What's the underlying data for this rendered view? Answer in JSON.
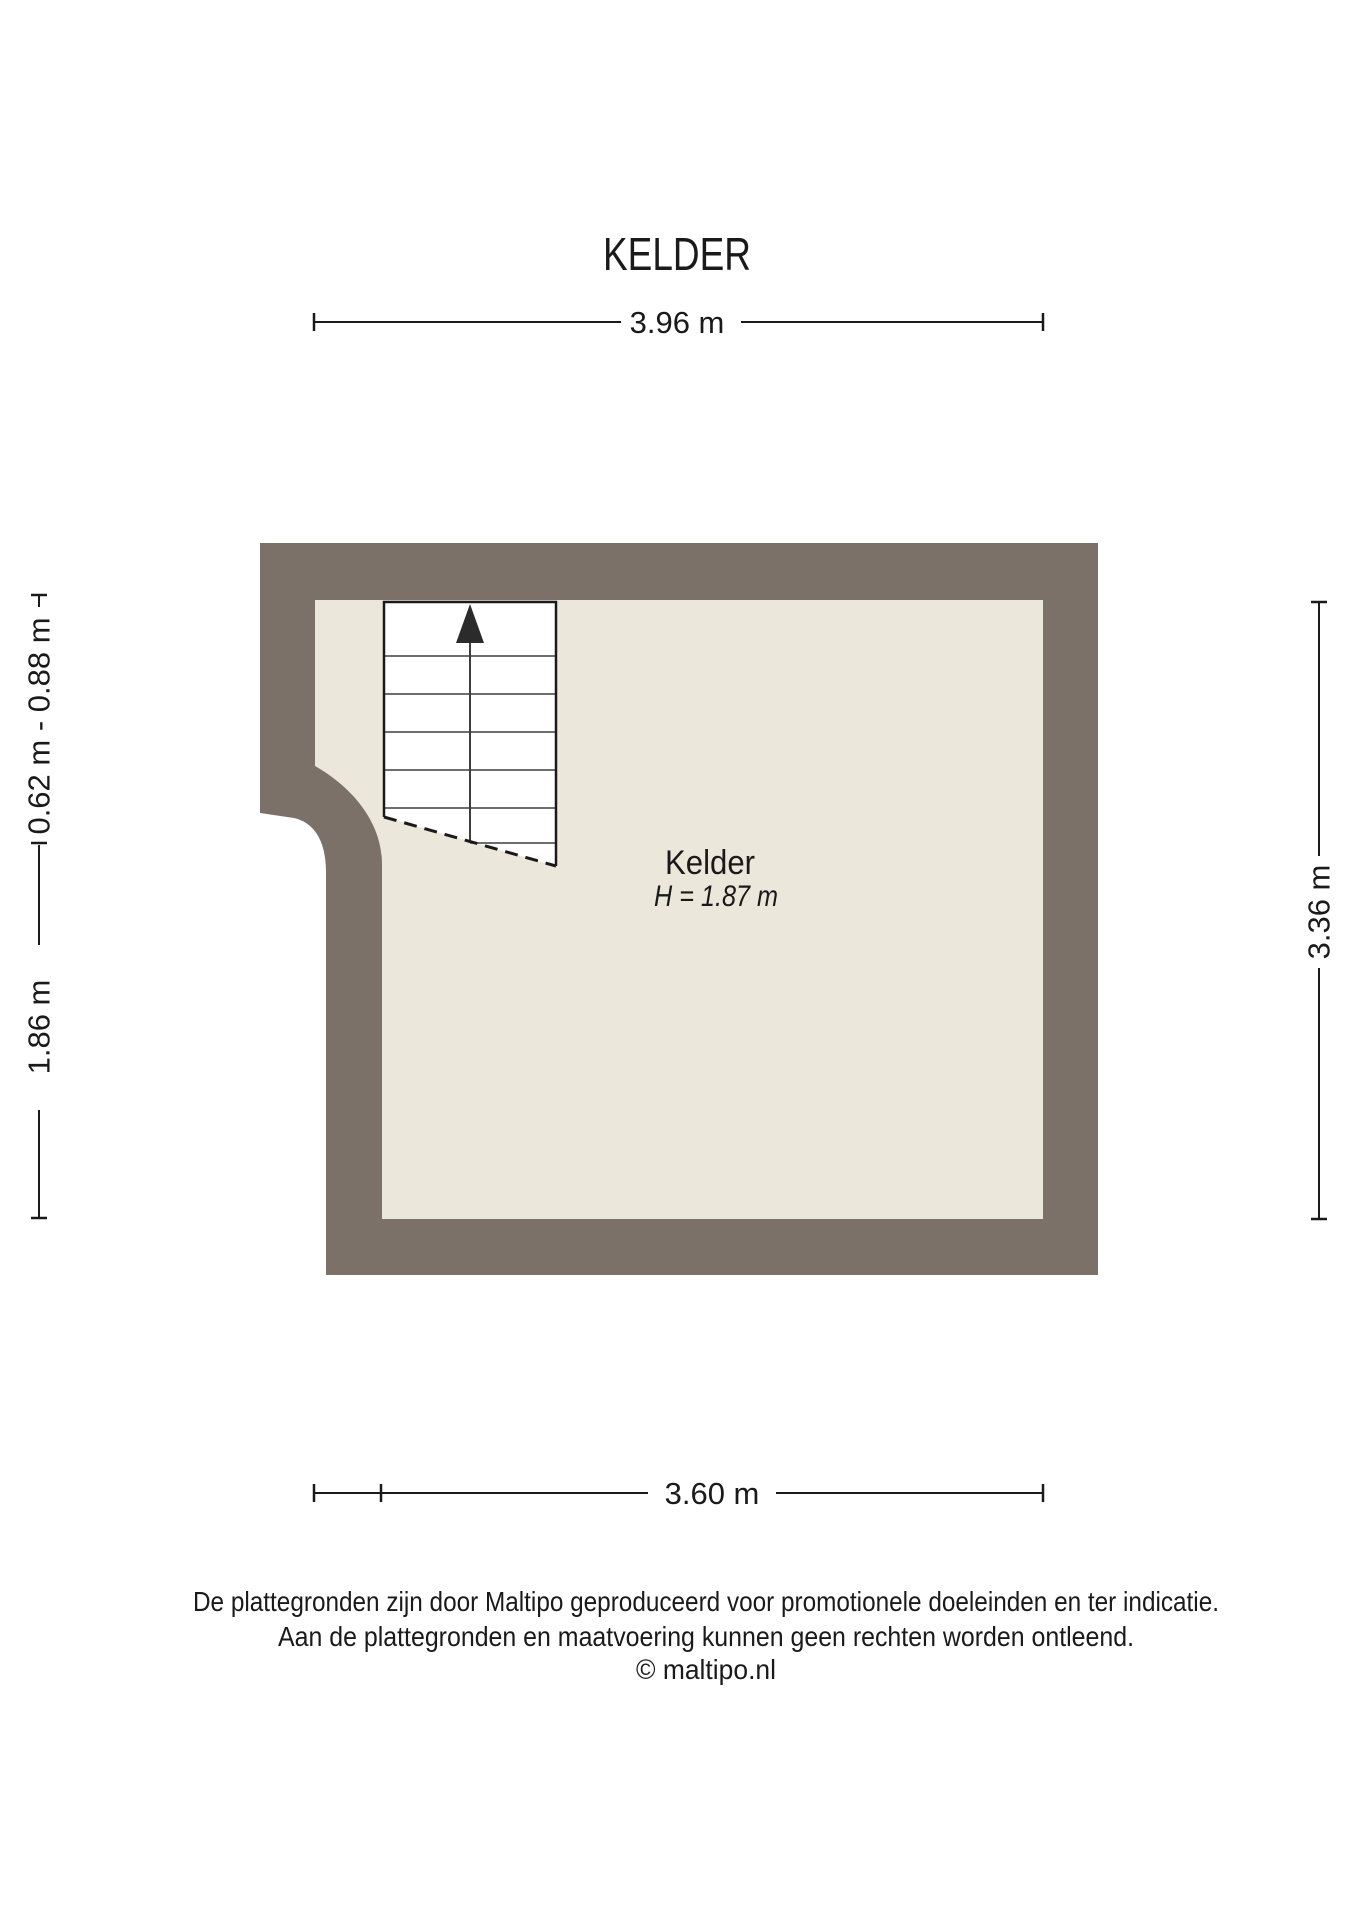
{
  "title": "KELDER",
  "dimensions": {
    "top": "3.96 m",
    "bottom": "3.60 m",
    "left_upper": "0.62 m - 0.88 m",
    "left_lower": "1.86 m",
    "right": "3.36 m"
  },
  "room": {
    "name": "Kelder",
    "height_label": "H = 1.87 m"
  },
  "footer": {
    "line1": "De plattegronden zijn door Maltipo geproduceerd voor promotionele doeleinden en ter indicatie.",
    "line2": "Aan de plattegronden en maatvoering kunnen geen rechten worden ontleend.",
    "line3": "© maltipo.nl"
  },
  "colors": {
    "wall": "#7b7168",
    "floor": "#ece7db",
    "line": "#1a1a1a",
    "steps": "#3f3f3f",
    "stairs": "#ffffff",
    "text": "#1a1a1a"
  }
}
